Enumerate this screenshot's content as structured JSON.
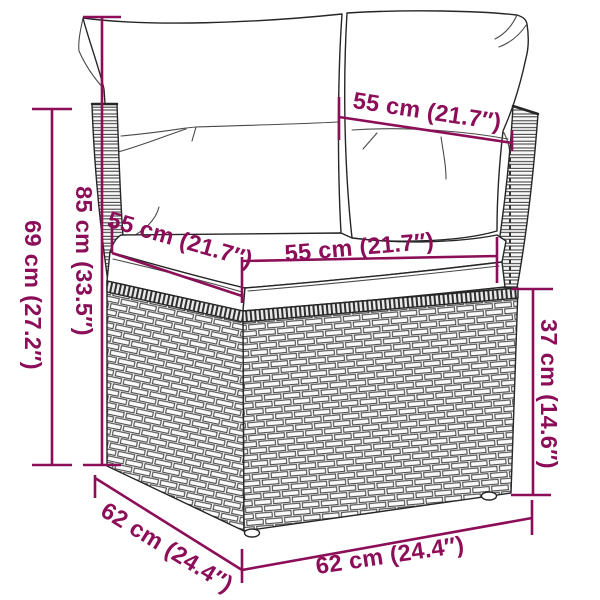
{
  "page": {
    "width": 600,
    "height": 600,
    "background": "#ffffff"
  },
  "colors": {
    "dimension_accent": "#8C0E58",
    "line_art": "#262626",
    "cushion_fill": "#ffffff"
  },
  "diagram": {
    "type": "product-dimension-diagram",
    "subject": "poly rattan corner sofa section with back cushions and seat cushion",
    "dimensions": [
      {
        "id": "total-height-left",
        "label": "85 cm (33.5″)"
      },
      {
        "id": "frame-height-left",
        "label": "69 cm (27.2″)"
      },
      {
        "id": "backrest-width-top",
        "label": "55 cm (21.7″)"
      },
      {
        "id": "seat-depth-left",
        "label": "55 cm (21.7″)"
      },
      {
        "id": "seat-width-front",
        "label": "55 cm (21.7″)"
      },
      {
        "id": "base-height-right",
        "label": "37 cm (14.6″)"
      },
      {
        "id": "base-depth-left",
        "label": "62 cm (24.4″)"
      },
      {
        "id": "base-width-front",
        "label": "62 cm (24.4″)"
      }
    ]
  }
}
